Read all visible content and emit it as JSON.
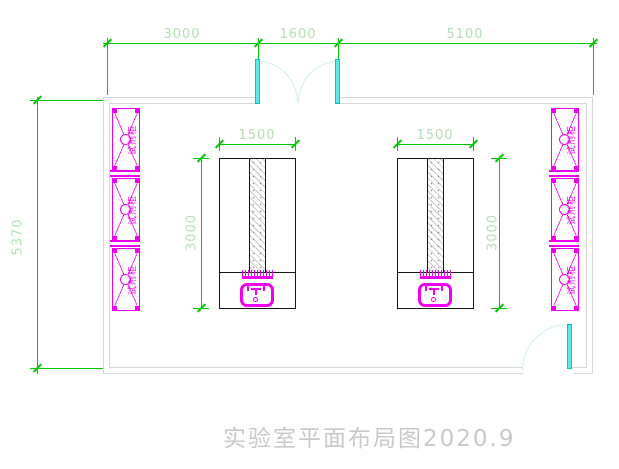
{
  "title": {
    "text": "实验室平面布局图2020.9"
  },
  "dimensions": {
    "top": [
      {
        "label": "3000"
      },
      {
        "label": "1600"
      },
      {
        "label": "5100"
      }
    ],
    "left_wall": {
      "label": "5370"
    },
    "left_island": {
      "width_label": "1500",
      "depth_label": "3000"
    },
    "right_island": {
      "width_label": "1500",
      "depth_label": "3000"
    }
  },
  "cabinets": {
    "label": "试剂柜",
    "left_count": 3,
    "right_count": 3
  },
  "colors": {
    "dimension_green": "#00c800",
    "dimension_text": "#b3e0b3",
    "cabinet_magenta": "#f000f0",
    "door_cyan": "#5ee8e8",
    "wall_gray": "#d9d9d9",
    "bench_outline": "#161616",
    "title_gray": "#c9c9c9"
  }
}
